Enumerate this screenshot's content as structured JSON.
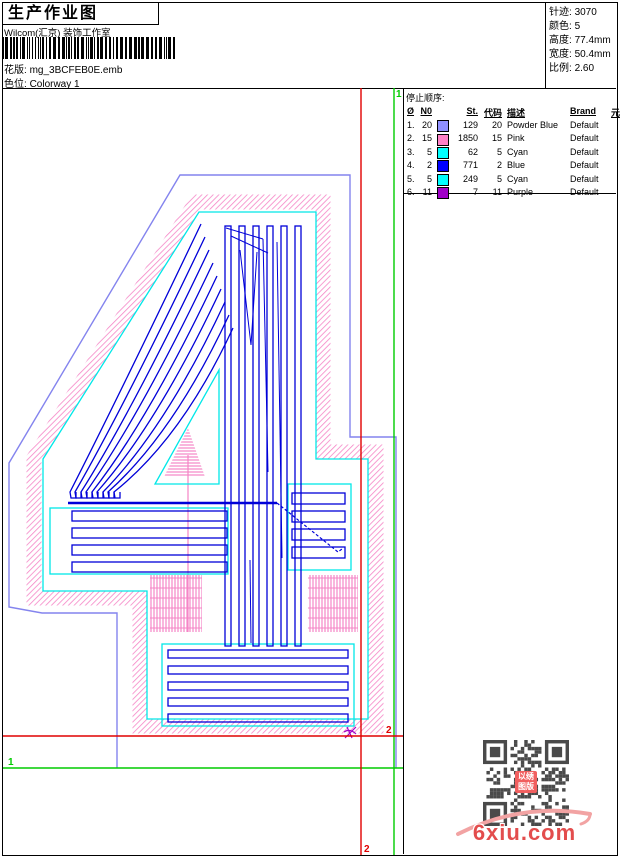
{
  "header": {
    "title": "生产作业图",
    "company": "Wilcom(汇京) 装饰工作室",
    "design_label": "花版:",
    "design_value": "mg_3BCFEB0E.emb",
    "colorway_label": "色位:",
    "colorway_value": "Colorway 1"
  },
  "info": {
    "rows": [
      {
        "label": "针迹:",
        "value": "3070"
      },
      {
        "label": "颜色:",
        "value": "5"
      },
      {
        "label": "高度:",
        "value": "77.4mm"
      },
      {
        "label": "宽度:",
        "value": "50.4mm"
      },
      {
        "label": "比例:",
        "value": "2.60"
      }
    ]
  },
  "stop_sequence": {
    "title": "停止顺序:",
    "columns": [
      "Ø",
      "N0",
      "",
      "St.",
      "代码",
      "描述",
      "Brand",
      "元素"
    ],
    "rows": [
      {
        "idx": "1.",
        "n0": "20",
        "color": "#9090FF",
        "st": "129",
        "code": "20",
        "desc": "Powder Blue",
        "brand": "Default",
        "element": ""
      },
      {
        "idx": "2.",
        "n0": "15",
        "color": "#FF82C8",
        "st": "1850",
        "code": "15",
        "desc": "Pink",
        "brand": "Default",
        "element": ""
      },
      {
        "idx": "3.",
        "n0": "5",
        "color": "#00FFFF",
        "st": "62",
        "code": "5",
        "desc": "Cyan",
        "brand": "Default",
        "element": ""
      },
      {
        "idx": "4.",
        "n0": "2",
        "color": "#0000FF",
        "st": "771",
        "code": "2",
        "desc": "Blue",
        "brand": "Default",
        "element": ""
      },
      {
        "idx": "5.",
        "n0": "5",
        "color": "#00FFFF",
        "st": "249",
        "code": "5",
        "desc": "Cyan",
        "brand": "Default",
        "element": ""
      },
      {
        "idx": "6.",
        "n0": "11",
        "color": "#A000C8",
        "st": "7",
        "code": "11",
        "desc": "Purple",
        "brand": "Default",
        "element": ""
      }
    ]
  },
  "markers": {
    "start_label": "1",
    "end_label": "2",
    "start_color": "#00CC00",
    "end_color": "#E00000"
  },
  "design_colors": {
    "powder_blue": "#8484EE",
    "pink": "#F584C6",
    "cyan": "#00E8E8",
    "blue": "#0000D8",
    "purple": "#A000C8"
  },
  "watermark": {
    "site": "6xiu.com",
    "stamp_line1": "以绣",
    "stamp_line2": "图版",
    "color": "#E34D4D"
  }
}
